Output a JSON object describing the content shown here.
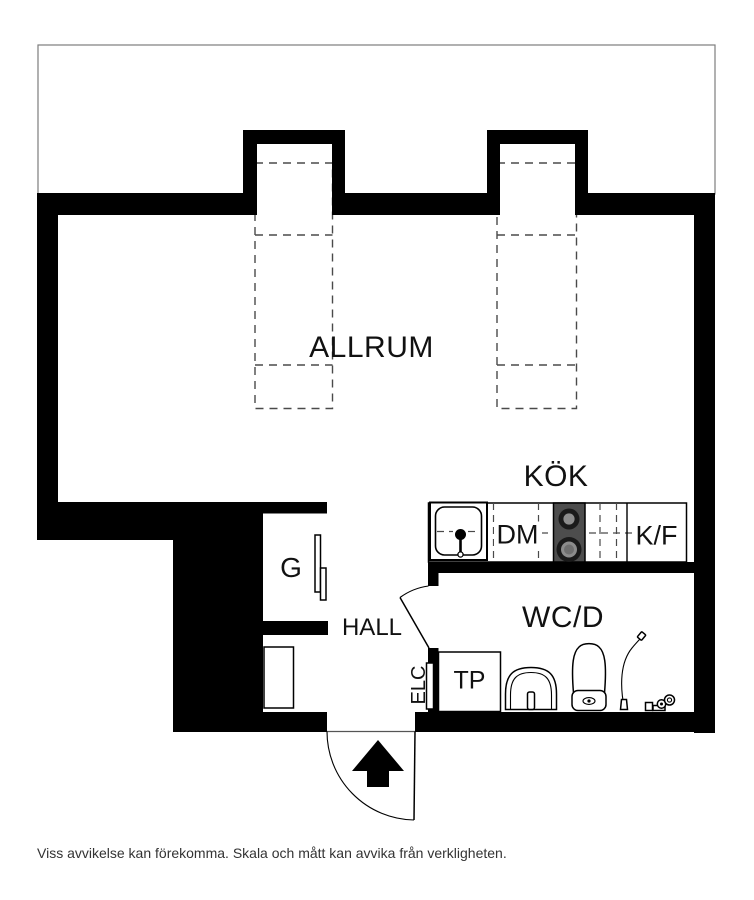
{
  "plan": {
    "rooms": {
      "allrum": "ALLRUM",
      "kok": "KÖK",
      "hall": "HALL",
      "wcd": "WC/D",
      "g": "G"
    },
    "fixtures": {
      "dm": "DM",
      "kf": "K/F",
      "tp": "TP",
      "elc": "ELC"
    },
    "disclaimer": "Viss avvikelse kan förekomma. Skala och mått kan avvika från verkligheten.",
    "colors": {
      "wall": "#000000",
      "stove": "#4d4d4d",
      "dash": "#4a4a4a",
      "outline": "#7d7d7d",
      "text": "#111111",
      "disclaimer": "#333333"
    }
  }
}
